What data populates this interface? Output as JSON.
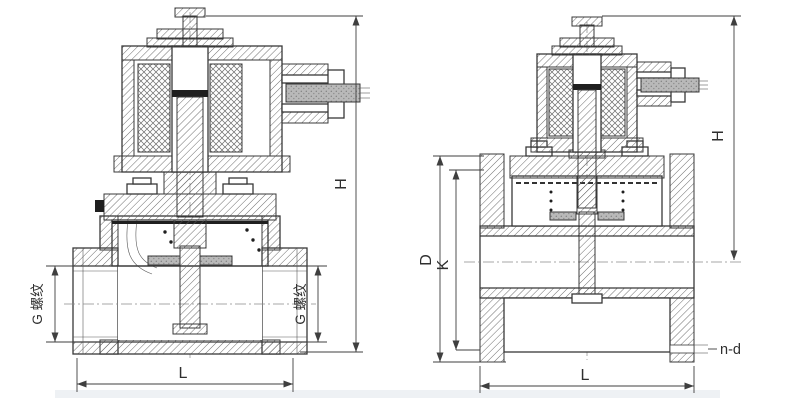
{
  "drawing": {
    "colors": {
      "line": "#383838",
      "background": "#ffffff",
      "cable_fill": "#b9b9b9",
      "footer_strip": "#eef1f4"
    },
    "left_valve": {
      "description": "threaded-port solenoid valve cross-section",
      "labels": {
        "height": "H",
        "length": "L",
        "port_left": "G 螺纹",
        "port_right": "G 螺纹"
      }
    },
    "right_valve": {
      "description": "flanged solenoid valve cross-section",
      "labels": {
        "height": "H",
        "length": "L",
        "flange_od": "D",
        "bolt_circle": "K",
        "bolt_holes": "n-d"
      }
    }
  }
}
